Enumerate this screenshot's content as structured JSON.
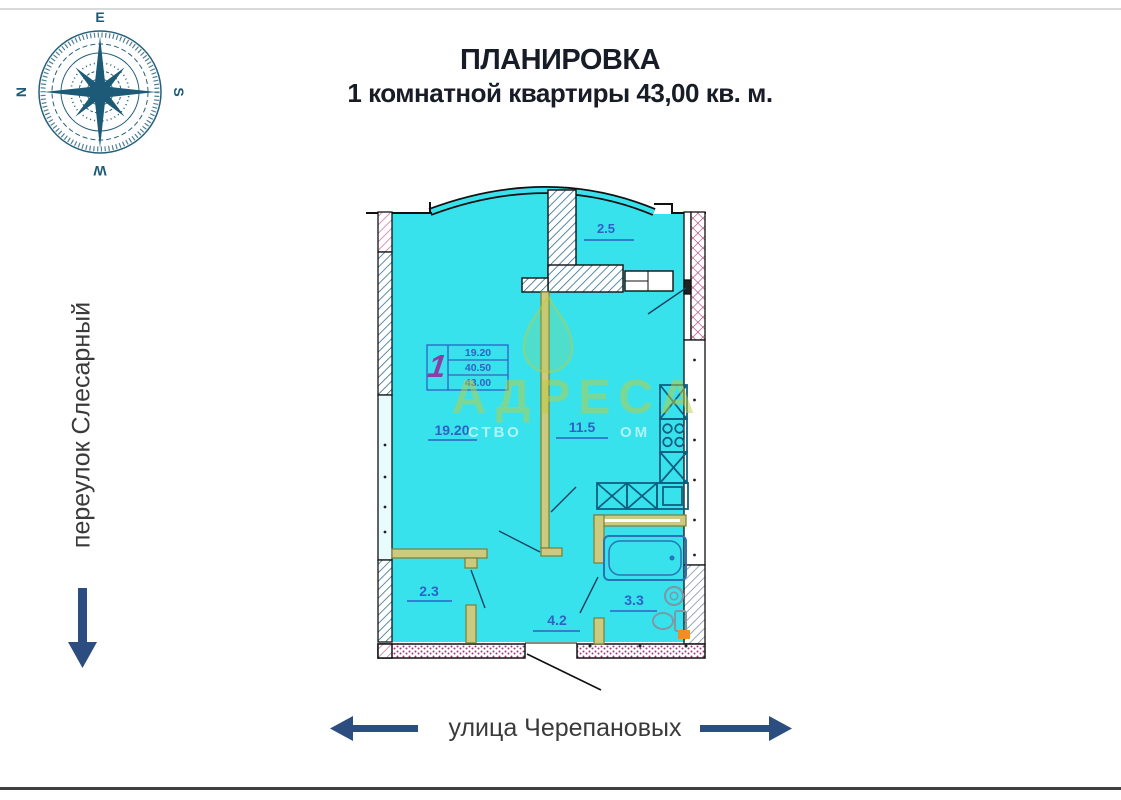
{
  "title": {
    "line1": "ПЛАНИРОВКА",
    "line2": "1 комнатной квартиры 43,00 кв. м."
  },
  "streets": {
    "left": "переулок Слесарный",
    "bottom": "улица Черепановых"
  },
  "compass": {
    "top": "E",
    "right": "S",
    "bottom": "W",
    "left": "N"
  },
  "legend": {
    "apartment_number": "1",
    "rows": [
      "19.20",
      "40.50",
      "43.00"
    ]
  },
  "rooms": {
    "living": "19.20",
    "kitchen": "11.5",
    "balcony": "2.5",
    "hall": "2.3",
    "corridor": "4.2",
    "bathroom": "3.3"
  },
  "watermark": {
    "text": "АДРЕСА",
    "fragment_left": "СТВО",
    "fragment_right": "ОМ"
  },
  "colors": {
    "plan_fill": "#38e2ec",
    "label_blue": "#2f62c4",
    "arrow_navy": "#2b4d80",
    "partition_olive": "#cbca7e",
    "hatch_blue": "#2f6f8f",
    "hatch_magenta": "#b03a7a",
    "watermark_olive": "#becc3e",
    "fixture_teal": "#0f5f80",
    "apartment_number_purple": "#8a3fa8",
    "orange": "#ef8f1f"
  }
}
